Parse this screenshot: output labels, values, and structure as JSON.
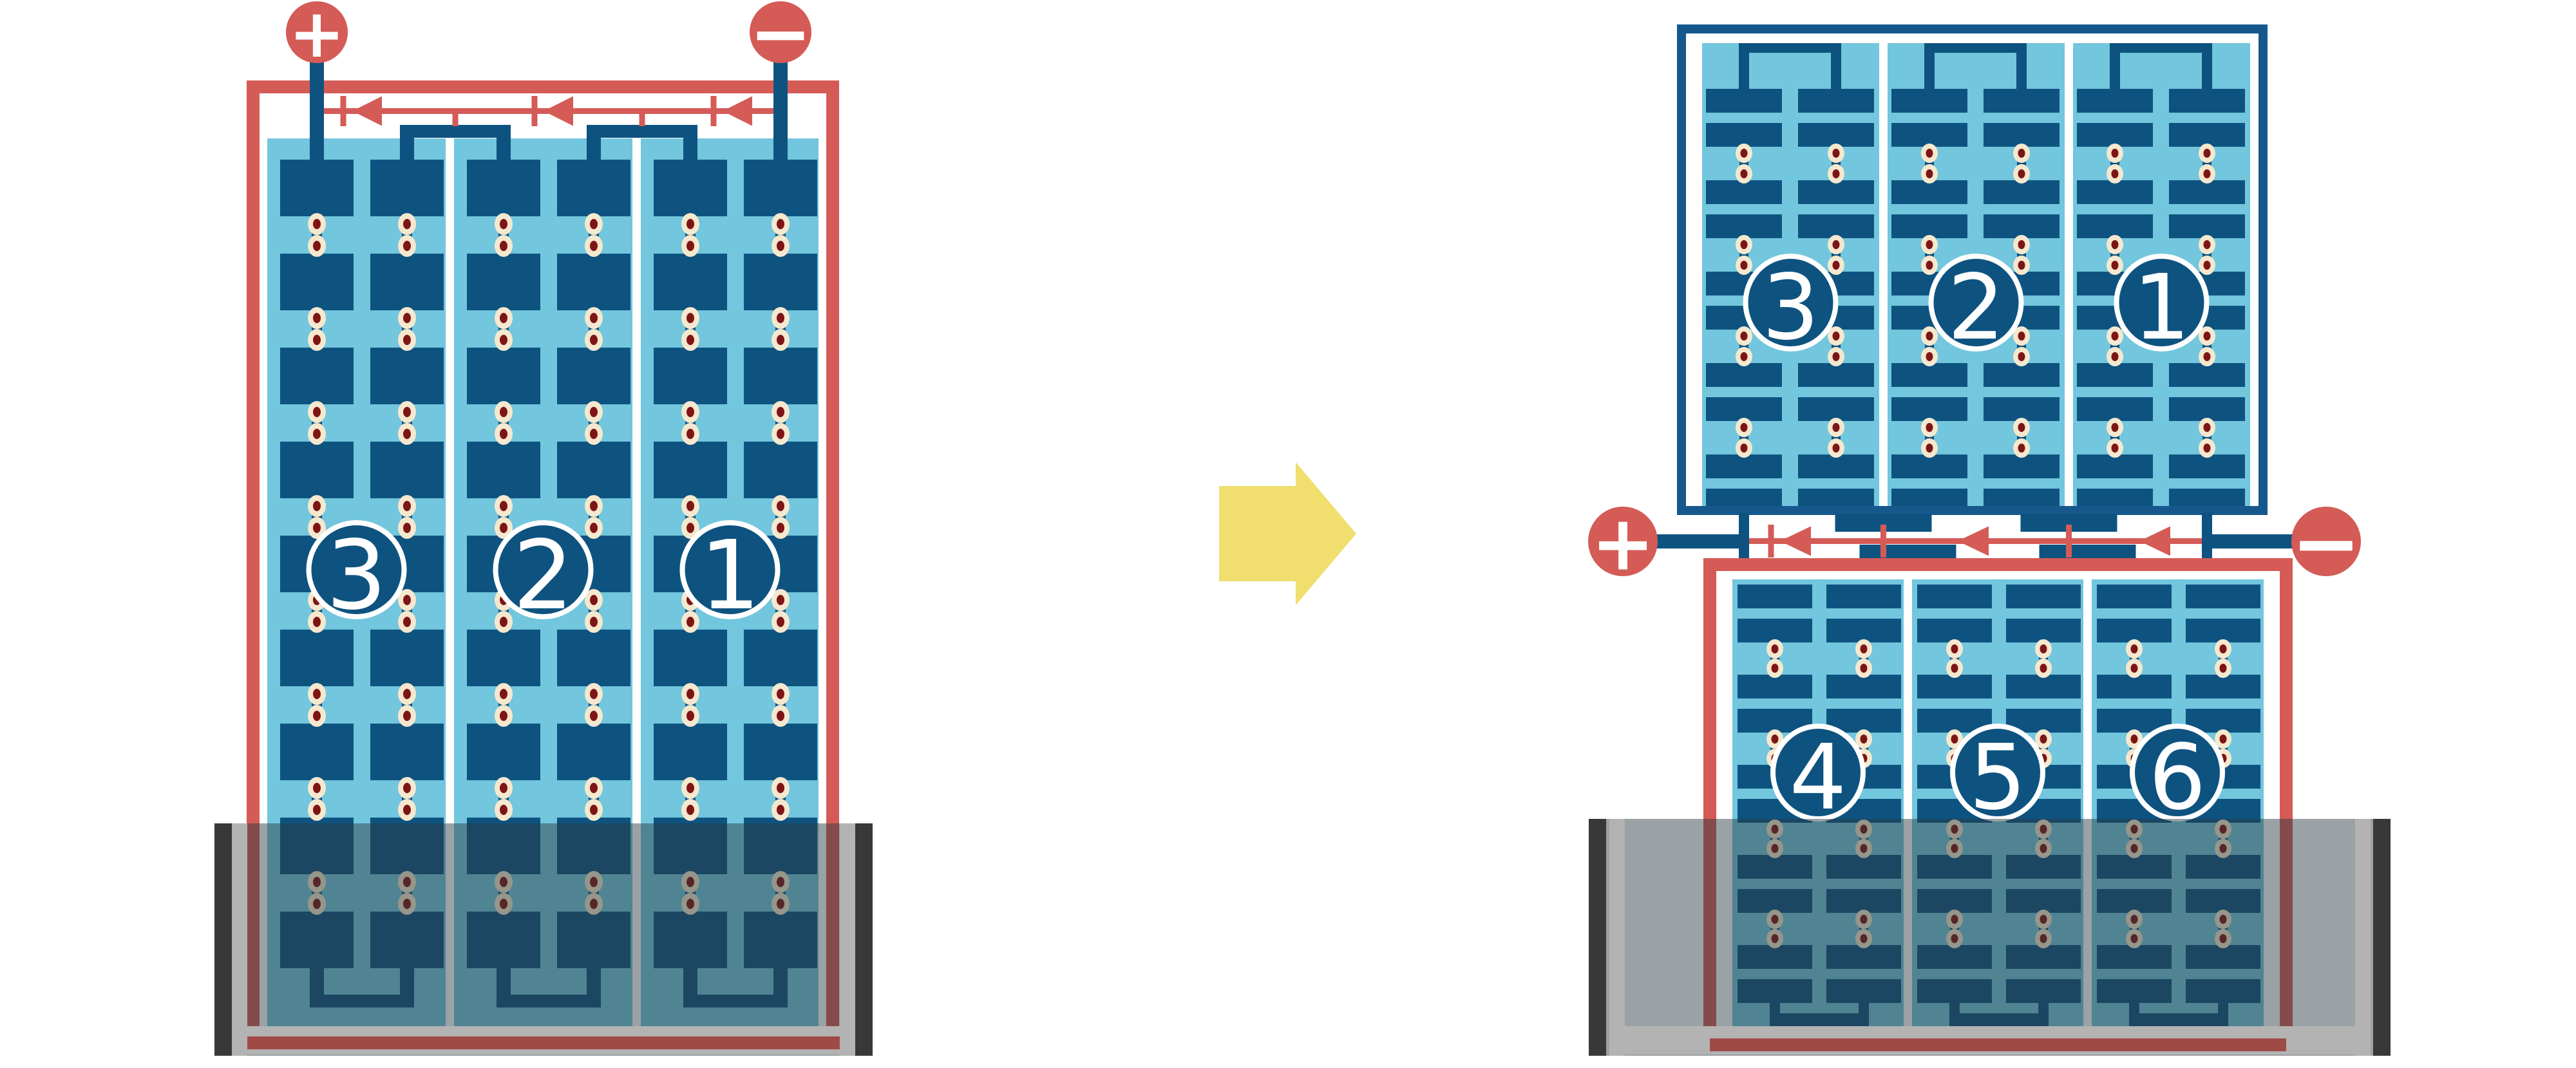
{
  "figure": {
    "left_battery": {
      "cell_labels": [
        "3",
        "2",
        "1"
      ],
      "positive_symbol": "+",
      "negative_symbol": "−"
    },
    "right_battery": {
      "top_unit_cell_labels": [
        "3",
        "2",
        "1"
      ],
      "bottom_unit_cell_labels": [
        "4",
        "5",
        "6"
      ],
      "positive_symbol": "+",
      "negative_symbol": "−"
    },
    "transform_arrow_icon": "right-arrow"
  },
  "colors": {
    "red": "#d45b56",
    "navy": "#0e5380",
    "border_blue": "#16588c",
    "light_blue": "#72c6dd",
    "separator_white": "#ffffff",
    "dot_ring": "#f5e8cf",
    "dot_core": "#7e1515",
    "arrow_yellow": "#f0de6e",
    "case_black": "#383838",
    "case_gray": "#b3b3b3",
    "case_shade": "rgba(43,58,64,0.47)",
    "label_text": "#ffffff",
    "background": "#ffffff"
  }
}
